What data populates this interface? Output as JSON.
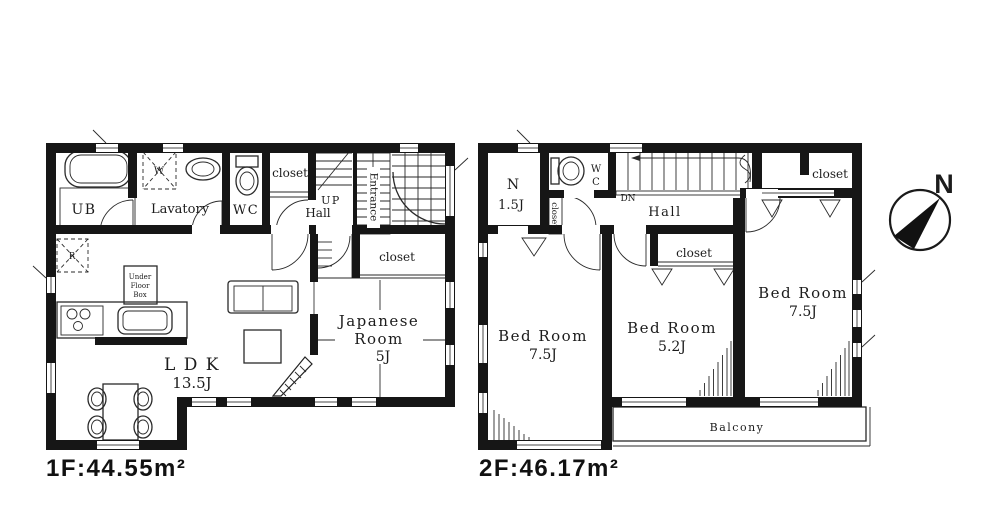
{
  "colors": {
    "wall": "#161616",
    "line": "#2a2a2a",
    "background": "#ffffff"
  },
  "compass": {
    "north": "N"
  },
  "f1": {
    "area": "1F:44.55m²",
    "ub": "UB",
    "washer": "W",
    "lavatory": "Lavatory",
    "wc": "WC",
    "closet_top": "closet",
    "up": "UP",
    "hall": "Hall",
    "entrance": "Entrance",
    "fridge": "R",
    "ufb1": "Under",
    "ufb2": "Floor",
    "ufb3": "Box",
    "ldk1": "L D K",
    "ldk2": "13.5J",
    "jr1": "Japanese",
    "jr2": "Room",
    "jr3": "5J",
    "closet_jr": "closet"
  },
  "f2": {
    "area": "2F:46.17m²",
    "n1": "N",
    "n2": "1.5J",
    "wc1": "W",
    "wc2": "C",
    "closet_side": "closet",
    "dn": "DN",
    "hall": "Hall",
    "closet_tr": "closet",
    "closet_mid": "closet",
    "bed1a": "Bed Room",
    "bed1b": "7.5J",
    "bed2a": "Bed Room",
    "bed2b": "5.2J",
    "bed3a": "Bed Room",
    "bed3b": "7.5J",
    "balcony": "Balcony"
  }
}
